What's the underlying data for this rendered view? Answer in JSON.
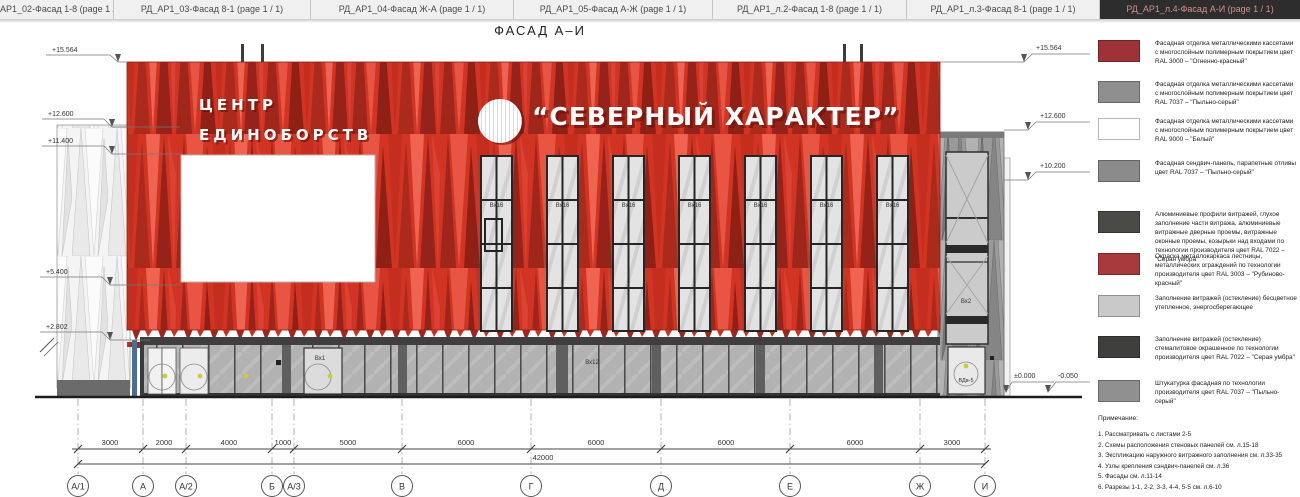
{
  "tabs": [
    {
      "label": "АР1_02-Фасад 1-8 (page 1 / 1)",
      "active": false
    },
    {
      "label": "РД_АР1_03-Фасад 8-1 (page 1 / 1)",
      "active": false
    },
    {
      "label": "РД_АР1_04-Фасад Ж-А (page 1 / 1)",
      "active": false
    },
    {
      "label": "РД_АР1_05-Фасад А-Ж (page 1 / 1)",
      "active": false
    },
    {
      "label": "РД_АР1_л.2-Фасад 1-8 (page 1 / 1)",
      "active": false
    },
    {
      "label": "РД_АР1_л.3-Фасад 8-1 (page 1 / 1)",
      "active": false
    },
    {
      "label": "РД_АР1_л.4-Фасад А-И (page 1 / 1)",
      "active": true
    }
  ],
  "title": "ФАСАД А–И",
  "building": {
    "sign_line1": "ЦЕНТР",
    "sign_line2": "ЕДИНОБОРСТВ",
    "banner": "“СЕВЕРНЫЙ ХАРАКТЕР”",
    "window_label": "Вх16",
    "entry_label": "Вх1",
    "storefront_label": "Вх12",
    "tower_window_label": "Вх2",
    "tower_door_label": "ВДв-5"
  },
  "elevations": {
    "left": [
      "+15.564",
      "+12.600",
      "+11.400",
      "+5.400",
      "+2.802"
    ],
    "right": [
      "+15.564",
      "+12.600",
      "+10.200",
      "±0.000",
      "-0.050"
    ]
  },
  "dimensions": {
    "segments": [
      "3000",
      "2000",
      "4000",
      "1000",
      "5000",
      "6000",
      "6000",
      "6000",
      "6000",
      "3000"
    ],
    "total": "42000"
  },
  "axes": [
    "А/1",
    "А",
    "А/2",
    "Б",
    "А/3",
    "В",
    "Г",
    "Д",
    "Е",
    "Ж",
    "И"
  ],
  "legend": {
    "items": [
      {
        "color": "#9d3337",
        "text": "Фасадная отделка металлическими кассетами с многослойным полимерным покрытием цвет RAL 3000 – \"Огненно-красный\""
      },
      {
        "color": "#8f8f8f",
        "text": "Фасадная отделка металлическими кассетами с многослойным полимерным покрытием цвет RAL 7037 – \"Пыльно-серый\""
      },
      {
        "color": "#ffffff",
        "text": "Фасадная отделка металлическими кассетами с многослойным полимерным покрытием цвет RAL 9000 – \"Белый\""
      },
      {
        "color": "#8b8b8b",
        "text": "Фасадная сендвич-панель, парапетные отливы цвет RAL 7037 – \"Пыльно-серый\""
      },
      {
        "color": "#4a4a46",
        "text": "Алюминиевые профили витражей, глухое заполнение части витража, алюминиевые витражные дверные проемы, витражные оконные проемы, козырьки над входами по технологии производителя цвет RAL 7022 – \"Серая умбра\""
      },
      {
        "color": "#a83a3c",
        "text": "Окраска металлокаркаса лестницы, металлических ограждений по технологии производителя цвет RAL 3003 – \"Рубиново-красный\""
      },
      {
        "color": "#c9c9c9",
        "text": "Заполнение витражей (остекление) бесцветное утепленное, энергосберегающее"
      },
      {
        "color": "#3f3f3d",
        "text": "Заполнение витражей (остекление) стемалитовое окрашенное по технологии производителя цвет RAL 7022 – \"Серая умбра\""
      },
      {
        "color": "#909090",
        "text": "Штукатурка фасадная по технологии производителя цвет RAL 7037 – \"Пыльно-серый\""
      }
    ]
  },
  "notes": {
    "heading": "Примечание:",
    "items": [
      "1.  Рассматривать с листами 2-5",
      "2.  Схемы расположения стеновых панелей см. л.15-18",
      "3.  Экспликацию наружного витражного заполнения см. л.33-35",
      "4.  Узлы крепления сэндвич-панелей см. л.36",
      "5.  Фасады см. л.11-14",
      "6.  Разрезы 1-1, 2-2, 3-3, 4-4, 5-5 см. л.6-10"
    ]
  },
  "colors": {
    "facade_red": "#d23424",
    "facade_red_dark": "#9e261a",
    "panel_gray": "#9a9a9a",
    "glass_gray": "#b2b2b2",
    "frame_dark": "#3f3f3f",
    "active_tab_bg": "#2d2d2d",
    "active_tab_text": "#cf9387"
  }
}
